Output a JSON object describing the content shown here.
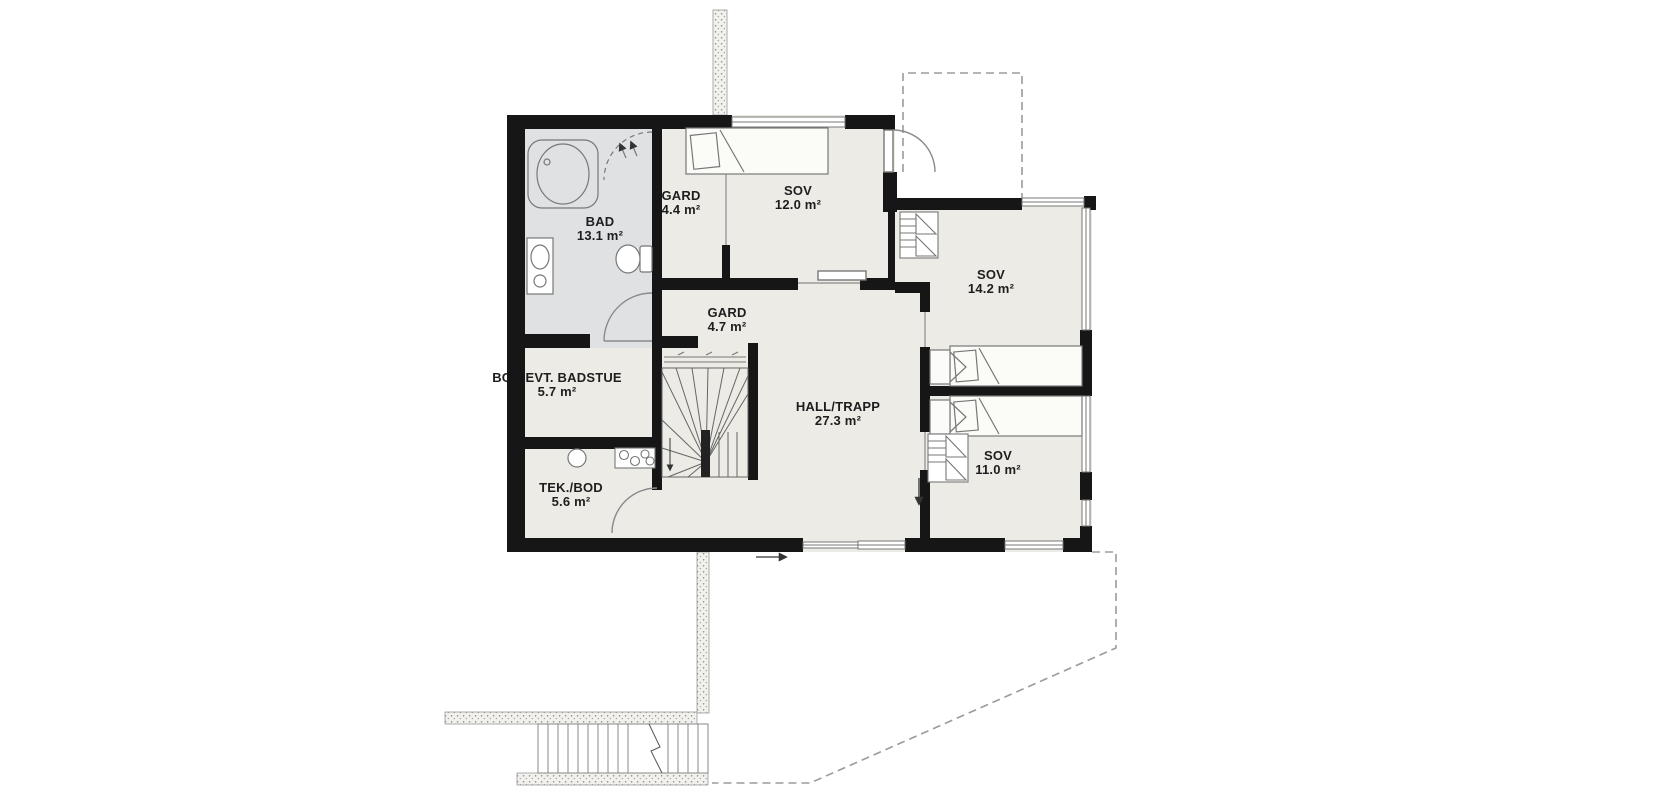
{
  "rooms": {
    "bad": {
      "name": "BAD",
      "area": "13.1 m²"
    },
    "gard44": {
      "name": "GARD",
      "area": "4.4 m²"
    },
    "sov12": {
      "name": "SOV",
      "area": "12.0 m²"
    },
    "sov142": {
      "name": "SOV",
      "area": "14.2 m²"
    },
    "gard47": {
      "name": "GARD",
      "area": "4.7 m²"
    },
    "hall": {
      "name": "HALL/TRAPP",
      "area": "27.3 m²"
    },
    "bod": {
      "name": "BOD/EVT. BADSTUE",
      "area": "5.7 m²"
    },
    "tek": {
      "name": "TEK./BOD",
      "area": "5.6 m²"
    },
    "sov11": {
      "name": "SOV",
      "area": "11.0 m²"
    }
  },
  "symbols": {
    "water_heater_label": "8.8"
  },
  "colors": {
    "wall": "#161616",
    "room_fill": "#ecebe6",
    "bathroom_fill": "#dfe1e3",
    "furniture_line": "#777777",
    "dashed_line": "#9b9b9b"
  }
}
